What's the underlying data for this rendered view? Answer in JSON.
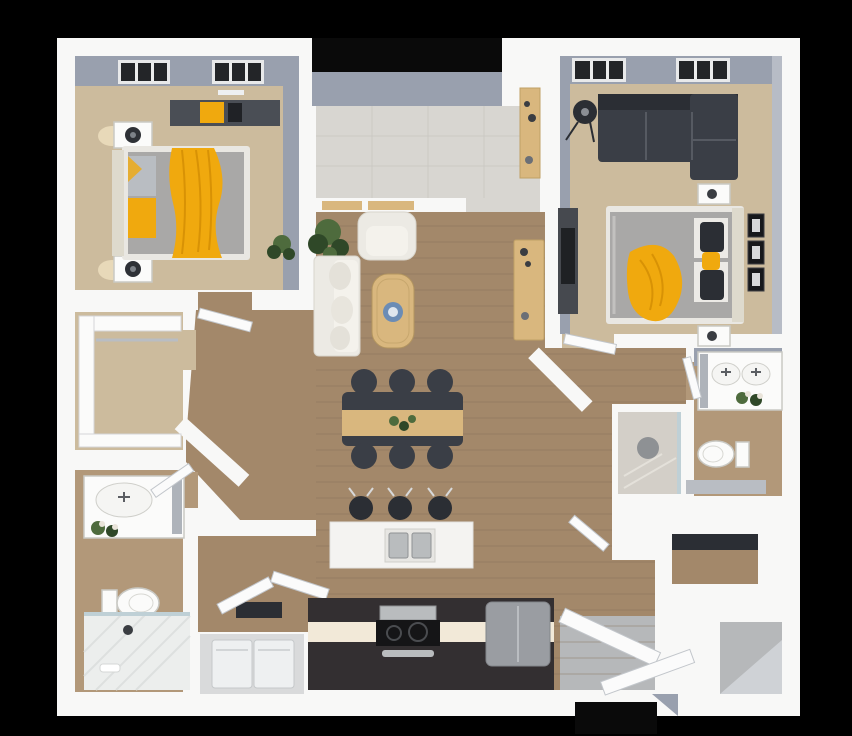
{
  "image": {
    "kind": "3d-rendered apartment floor plan, top-down view",
    "background": "black rounded-corner canvas"
  },
  "colors": {
    "bg": "#000000",
    "black": "#0a0a0a",
    "wall": "#f8f8f7",
    "wallFace": "#99a0ae",
    "wallFaceLight": "#b7bcc6",
    "carpet": "#ccbb9d",
    "wood": "#a3886a",
    "woodLine": "#86705a",
    "tile": "#d8d6d1",
    "tileLine": "#c4c2bc",
    "bathWood": "#b29879",
    "laundry": "#d9dadb",
    "patio": "#b6b8ba",
    "showerTile": "#d3cfc8",
    "glass": "#bfd0d6",
    "white": "#fbfbfa",
    "island": "#f4f3f1",
    "sofa": "#eceae4",
    "bedGray": "#a9a8a7",
    "bedFrame": "#e9e7e2",
    "headboard": "#dedacd",
    "furnDark": "#3a3e46",
    "furnDarker": "#2b2e34",
    "counterDark": "#332f31",
    "counterGlow": "#f2e9d8",
    "steel": "#b9bcbe",
    "tan": "#d9b77e",
    "yellow": "#f0a90e",
    "plant": "#4e6b3d",
    "plantDark": "#2f4828",
    "plate": "#6b8cb5",
    "appliance": "#eef0f1",
    "mirror": "#aeb3ba",
    "grayBench": "#b9bdc3",
    "door": "#fbfbfb",
    "doorStroke": "#c2c6cb",
    "glow": "#fff3cf"
  },
  "rooms": [
    {
      "id": "bedroom-1",
      "floor": "carpet",
      "furniture": [
        "bed with yellow throw and patterned pillows",
        "nightstand with lamp (x2)",
        "dark dresser with yellow decor",
        "floor plant",
        "two windows"
      ]
    },
    {
      "id": "walk-in-closet",
      "floor": "carpet",
      "furniture": [
        "white wrap-around shelving"
      ]
    },
    {
      "id": "bathroom-1",
      "floor": "wood",
      "furniture": [
        "vanity with sink and flowers",
        "toilet",
        "walk-in tiled shower"
      ]
    },
    {
      "id": "laundry-closet",
      "floor": "gray",
      "furniture": [
        "washer",
        "dryer",
        "open bifold doors"
      ]
    },
    {
      "id": "entry",
      "floor": "tile",
      "furniture": [
        "recessed front door",
        "shoe cabinet",
        "transom windows"
      ]
    },
    {
      "id": "living-room",
      "floor": "wood plank",
      "furniture": [
        "white sofa",
        "white armchair",
        "potted plant",
        "oval wood coffee table with blue plate",
        "tan media console"
      ]
    },
    {
      "id": "dining-area",
      "floor": "wood plank",
      "furniture": [
        "dark dining table with tan runner and greenery",
        "six dark chairs"
      ]
    },
    {
      "id": "kitchen",
      "floor": "wood plank",
      "furniture": [
        "white island with double sink",
        "three black bar stools",
        "dark counter with under-glow",
        "range cooktop",
        "gray refrigerator"
      ]
    },
    {
      "id": "bedroom-2",
      "floor": "carpet",
      "furniture": [
        "dark sectional sofa",
        "black floor lamp",
        "bed with gray duvet and yellow blanket",
        "nightstand (x2)",
        "dark wardrobe / TV unit",
        "three wall frames",
        "two windows"
      ]
    },
    {
      "id": "bathroom-2",
      "floor": "wood",
      "furniture": [
        "double-sink vanity with flowers",
        "toilet",
        "gray bench counter",
        "shower stall with glass"
      ]
    },
    {
      "id": "storage-closets",
      "floor": "mixed",
      "furniture": [
        "shelved closet (x2)",
        "open rear patio doors"
      ]
    }
  ]
}
